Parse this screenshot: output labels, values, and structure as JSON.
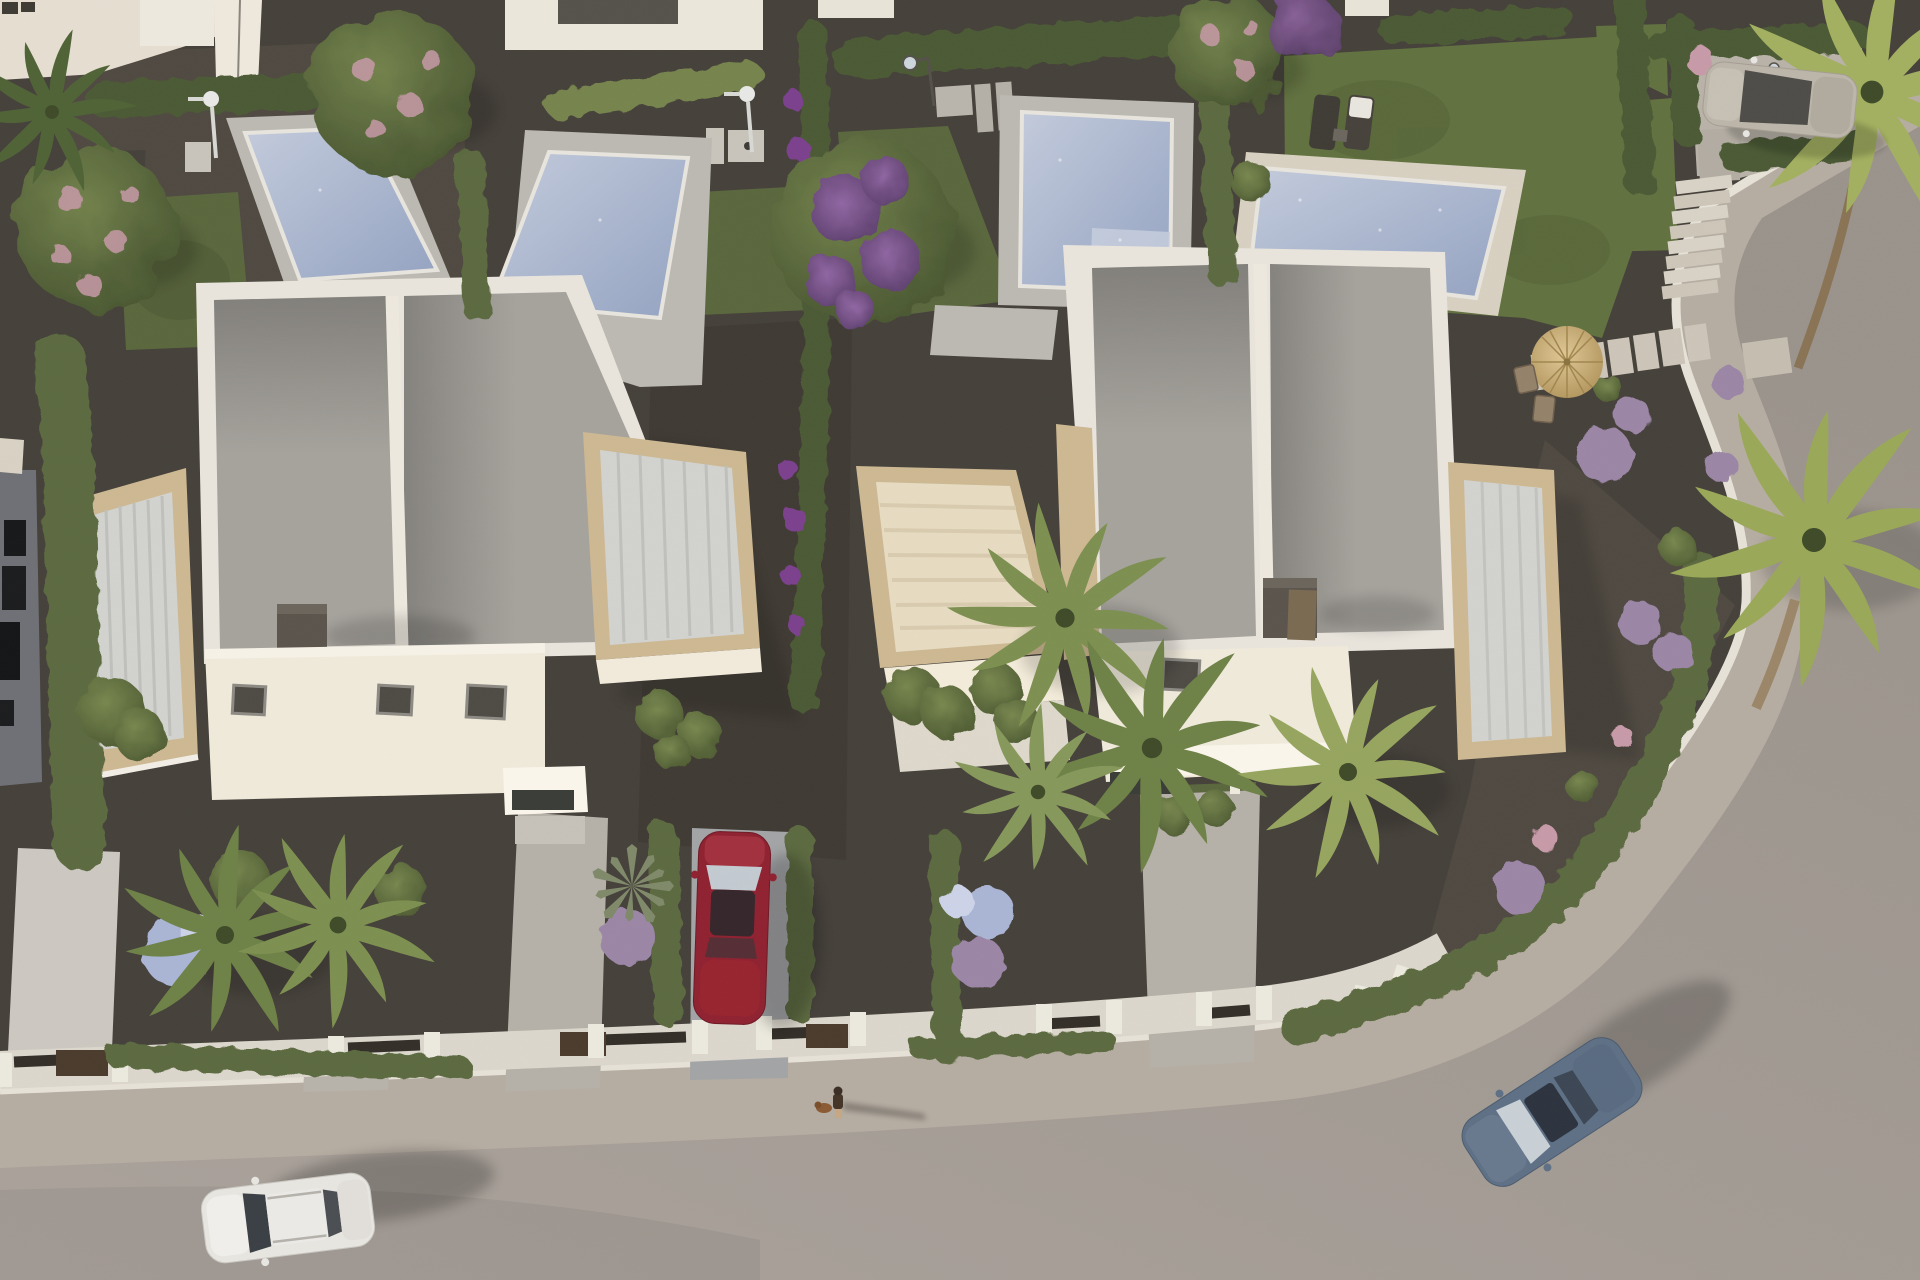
{
  "scene": {
    "medium": "aerial-3d-architectural-render",
    "subject": "two white duplex villas with private pools, gardens and a curved corner street"
  },
  "colors": {
    "gravel": "#45403a",
    "gravelLight": "#514b43",
    "grass": "#5a673d",
    "lawn": "#61713f",
    "hedge": "#5c6b40",
    "hedgeDark": "#4c5a34",
    "hedgeLight": "#76844e",
    "road": "#a29a93",
    "sidewalk": "#b6ada2",
    "curb": "#e7e2d8",
    "frontWall": "#dcd7cd",
    "wallCap": "#332e28",
    "parapet": "#e9e5dd",
    "roofGravel": "#a6a39d",
    "sunlitWall": "#f0eadb",
    "travertine": "#cdb892",
    "pergolaSlat": "#d2d3cf",
    "pergolaCream": "#e7dcc2",
    "poolDeck": "#bcb9b2",
    "poolDeckWarm": "#d8d1c2",
    "poolWater": "#94a3c2",
    "poolWaterLight": "#c3cbdc",
    "chimney": "#5a544c",
    "parasol": "#d3b87f",
    "palm": "#7d9050",
    "palmYellow": "#a3b060",
    "flowerPurple": "#7c3f8e",
    "flowerMauve": "#9b86a6",
    "flowerBlue": "#aab4d4",
    "flowerPink": "#c79aa8"
  },
  "inventory": {
    "villas": 2,
    "swimming_pools": 4,
    "pedestrians": 1,
    "dogs": 1,
    "sun_loungers": 2,
    "parasols": 1,
    "outdoor_showers": 2,
    "street_lamps": 2,
    "staircase_steps": 8,
    "cars": [
      {
        "color_name": "white",
        "hex": "#e8e6e1",
        "location": "road bottom-left"
      },
      {
        "color_name": "dark red",
        "hex": "#8f2130",
        "location": "center driveway"
      },
      {
        "color_name": "slate blue",
        "hex": "#5e7086",
        "location": "road right bend"
      },
      {
        "color_name": "silver beige",
        "hex": "#bcb5aa",
        "location": "top-right parking"
      }
    ]
  }
}
